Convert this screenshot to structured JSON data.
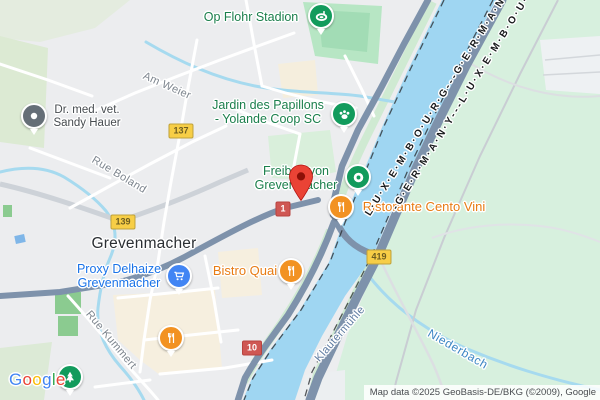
{
  "labels": {
    "stadium": "Op Flohr Stadion",
    "vet1": "Dr. med. vet.",
    "vet2": "Sandy Hauer",
    "jardin1": "Jardin des Papillons",
    "jardin2": "- Yolande Coop SC",
    "freibad1": "Freibad von",
    "freibad2": "Grevenmacher",
    "ristorante": "Ristorante Cento Vini",
    "bistro": "Bistro Quai",
    "proxy1": "Proxy Delhaize",
    "proxy2": "Grevenmacher",
    "city": "Grevenmacher",
    "am_weier": "Am Weier",
    "rue_boland": "Rue Boland",
    "rue_kummert": "Rue Kummert",
    "klautermuhle": "Klautermühle",
    "niederbach": "Niederbach",
    "border_a": "L·U·X·E·M·B·O·U·R·G---G·E·R·M·A·N·Y-",
    "border_b": "-G·E·R·M·A·N·Y---L·U·X·E·M·B·O·U·R·G"
  },
  "shields": {
    "cr137": "137",
    "cr139": "139",
    "b419": "419",
    "n1": "1",
    "n10": "10"
  },
  "pins": [
    {
      "name": "stadium-pin",
      "icon": "stadium-icon",
      "color": "#129b5c"
    },
    {
      "name": "vet-pin",
      "icon": "poi-dot-icon",
      "color": "#656e77"
    },
    {
      "name": "jardin-pin",
      "icon": "paw-icon",
      "color": "#129b5c"
    },
    {
      "name": "freibad-pin",
      "icon": "pool-ring-icon",
      "color": "#129b5c"
    },
    {
      "name": "ristorante-pin",
      "icon": "restaurant-icon",
      "color": "#f29222"
    },
    {
      "name": "bistro-pin",
      "icon": "restaurant-icon",
      "color": "#f29222"
    },
    {
      "name": "proxy-pin",
      "icon": "shopping-cart-icon",
      "color": "#4285f4"
    },
    {
      "name": "town-restaurant-pin",
      "icon": "restaurant-icon",
      "color": "#f29222"
    },
    {
      "name": "park-pin",
      "icon": "tree-icon",
      "color": "#129b5c"
    },
    {
      "name": "destination-marker",
      "icon": "red-pin-icon",
      "color": "#ea4335"
    }
  ],
  "google": {
    "letters": [
      "G",
      "o",
      "o",
      "g",
      "l",
      "e"
    ],
    "letter_colors": [
      "#4285F4",
      "#EA4335",
      "#FBBC05",
      "#4285F4",
      "#34A853",
      "#EA4335"
    ]
  },
  "attribution": {
    "text": "Map data ©2025 GeoBasis-DE/BKG (©2009), Google"
  },
  "colors": {
    "water": "#9fd6f2",
    "land_urban": "#ecedef",
    "land_germany": "#d7f0de",
    "park_green": "#b7e6c4",
    "sage_green": "#dcead3",
    "downtown_beige": "#f6efdf",
    "major_road": "#7e92ab",
    "minor_road": "#ffffff",
    "secondary_road": "#cdd2d8",
    "railway": "#c9cdd3",
    "border_dash": "#2a2d30",
    "shield_yellow": "#f7ce46",
    "shield_red": "#cf5753"
  }
}
